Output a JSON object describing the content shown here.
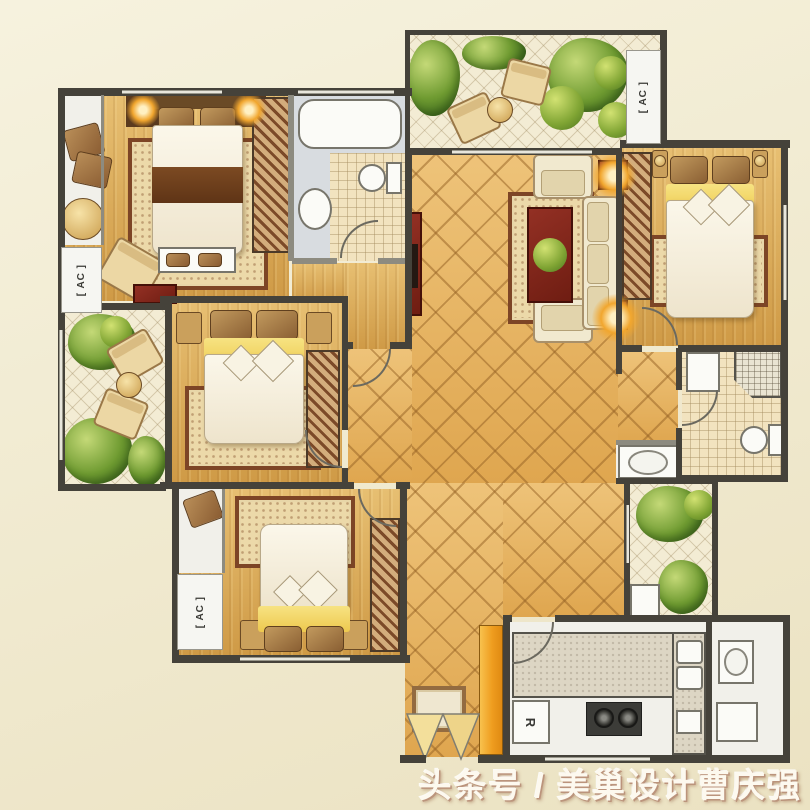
{
  "watermark": {
    "text": "头条号 / 美巢设计曹庆强"
  },
  "labels": {
    "ac": "[ AC ]",
    "fridge": "R"
  },
  "colors": {
    "bg1": "#f6f2de",
    "bg2": "#ebe2c2",
    "wall": "#45423a",
    "wood1": "#e7bf72",
    "wood2": "#cf9a46",
    "gold1": "#eec379",
    "gold2": "#dfa64f",
    "goldline": "rgba(150,98,36,0.5)",
    "cream1": "#f3ecd4",
    "creamline": "rgba(165,145,105,0.38)",
    "bath1": "#f2e3bf",
    "bathline": "rgba(165,140,95,0.45)",
    "gray1": "#d8dce0",
    "hatch1": "#d3ad7c",
    "hatch2": "#7c4a28",
    "rug1": "#ecd9a9",
    "rug2": "#7d4526",
    "plant1": "#c4d977",
    "plant2": "#6f9b31",
    "plant3": "#3f6b1f",
    "wm1": "#fdf9ef",
    "wm2": "#bb947c"
  }
}
